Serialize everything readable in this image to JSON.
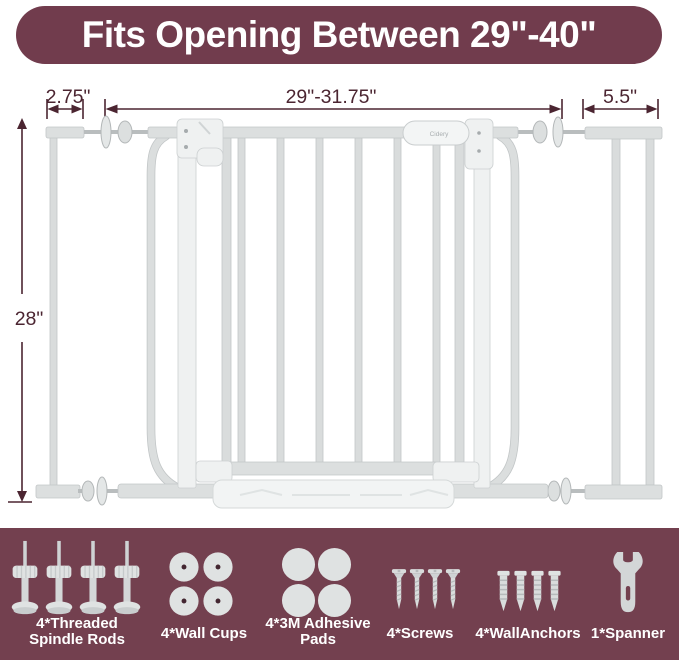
{
  "banner": {
    "text": "Fits Opening Between 29\"-40\"",
    "bg_color": "#713c4d",
    "text_color": "#ffffff"
  },
  "diagram": {
    "dim_left": "2.75\"",
    "dim_main": "29\"-31.75\"",
    "dim_right": "5.5\"",
    "dim_height": "28\"",
    "brand": "Cidery",
    "dim_color": "#4b2531",
    "gate_color": "#dcdfdf"
  },
  "accessories": {
    "bg_color": "#73404f",
    "text_color": "#ffffff",
    "items": [
      {
        "name": "threaded-spindle-rods",
        "label": "4*Threaded Spindle Rods",
        "count": 4
      },
      {
        "name": "wall-cups",
        "label": "4*Wall Cups",
        "count": 4
      },
      {
        "name": "3m-adhesive-pads",
        "label": "4*3M Adhesive Pads",
        "count": 4
      },
      {
        "name": "screws",
        "label": "4*Screws",
        "count": 4
      },
      {
        "name": "wall-anchors",
        "label": "4*WallAnchors",
        "count": 4
      },
      {
        "name": "spanner",
        "label": "1*Spanner",
        "count": 1
      }
    ]
  }
}
